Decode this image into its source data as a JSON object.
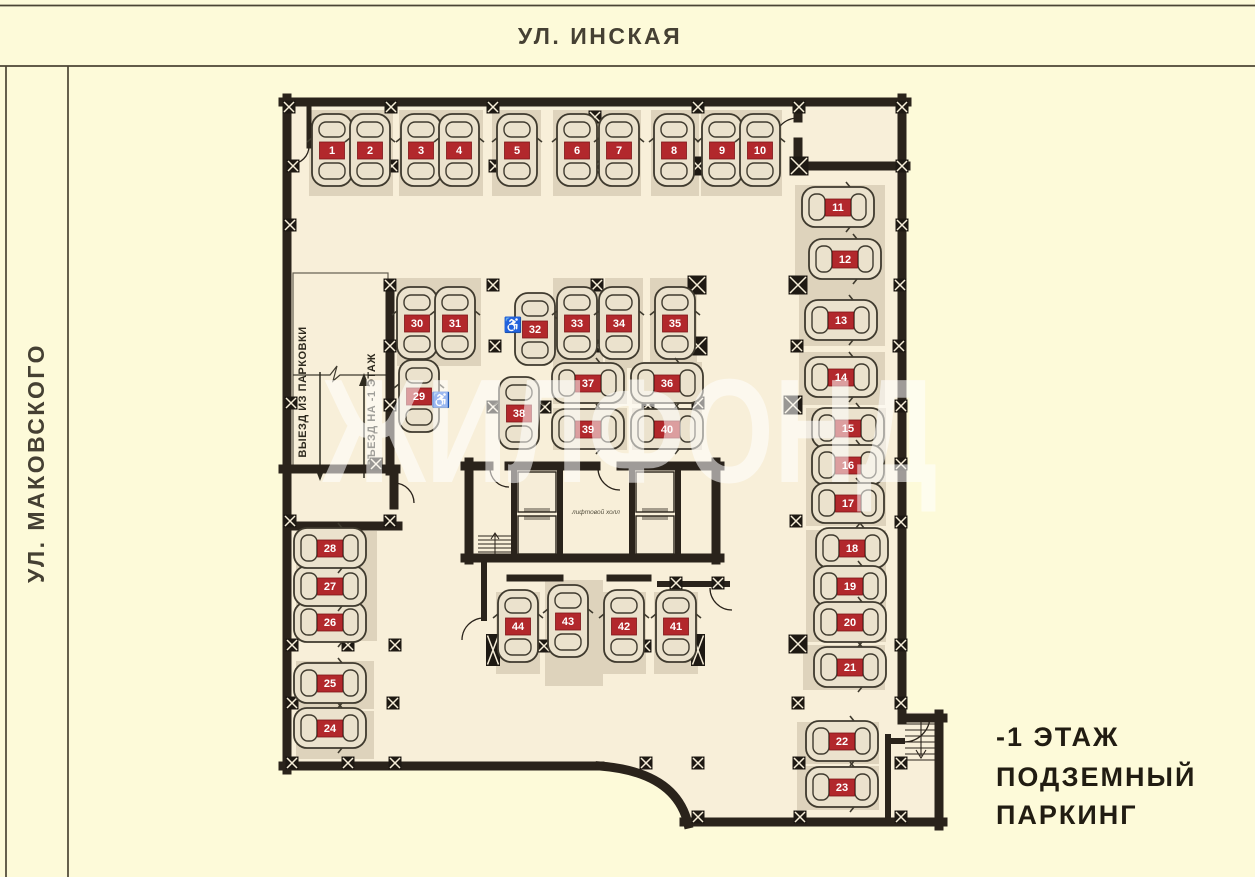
{
  "streets": {
    "top": "УЛ. ИНСКАЯ",
    "left": "УЛ. МАКОВСКОГО"
  },
  "floor_label": {
    "line1": "-1 ЭТАЖ",
    "line2": "ПОДЗЕМНЫЙ",
    "line3": "ПАРКИНГ"
  },
  "watermark": "ЖИЛФОНД",
  "ramp": {
    "exit_label": "ВЫЕЗД ИЗ ПАРКОВКИ",
    "entry_label": "ВЪЕЗД НА -1 ЭТАЖ"
  },
  "elevator_hall_label": "лифтовой холл",
  "colors": {
    "street_bg": "#fdfad9",
    "floor": "#f8efd9",
    "stall": "#ded3bc",
    "wall": "#2a231b",
    "badge": "#b2282c",
    "badge_text": "#ffffff",
    "frame_line": "#4b4434",
    "street_text": "#454033",
    "title_text": "#211c12",
    "car_body": "#ebe2cd",
    "car_outline": "#3f3a2e",
    "watermark_fill": "rgba(255,255,255,0.55)"
  },
  "plan": {
    "spots": [
      [
        1,
        332,
        150,
        "v"
      ],
      [
        2,
        370,
        150,
        "v"
      ],
      [
        3,
        421,
        150,
        "v"
      ],
      [
        4,
        459,
        150,
        "v"
      ],
      [
        5,
        517,
        150,
        "v"
      ],
      [
        6,
        577,
        150,
        "v"
      ],
      [
        7,
        619,
        150,
        "v"
      ],
      [
        8,
        674,
        150,
        "v"
      ],
      [
        9,
        722,
        150,
        "v"
      ],
      [
        10,
        760,
        150,
        "v"
      ],
      [
        11,
        838,
        207,
        "h"
      ],
      [
        12,
        845,
        259,
        "h"
      ],
      [
        13,
        841,
        320,
        "h"
      ],
      [
        14,
        841,
        377,
        "h"
      ],
      [
        15,
        848,
        428,
        "h"
      ],
      [
        16,
        848,
        465,
        "h"
      ],
      [
        17,
        848,
        503,
        "h"
      ],
      [
        18,
        852,
        548,
        "h"
      ],
      [
        19,
        850,
        586,
        "h"
      ],
      [
        20,
        850,
        622,
        "h"
      ],
      [
        21,
        850,
        667,
        "h"
      ],
      [
        22,
        842,
        741,
        "h"
      ],
      [
        23,
        842,
        787,
        "h"
      ],
      [
        24,
        330,
        728,
        "h"
      ],
      [
        25,
        330,
        683,
        "h"
      ],
      [
        26,
        330,
        622,
        "h"
      ],
      [
        27,
        330,
        586,
        "h"
      ],
      [
        28,
        330,
        548,
        "h"
      ],
      [
        29,
        419,
        396,
        "v"
      ],
      [
        30,
        417,
        323,
        "v"
      ],
      [
        31,
        455,
        323,
        "v"
      ],
      [
        32,
        535,
        329,
        "v"
      ],
      [
        33,
        577,
        323,
        "v"
      ],
      [
        34,
        619,
        323,
        "v"
      ],
      [
        35,
        675,
        323,
        "v"
      ],
      [
        36,
        667,
        383,
        "h"
      ],
      [
        37,
        588,
        383,
        "h"
      ],
      [
        38,
        519,
        413,
        "v"
      ],
      [
        39,
        588,
        429,
        "h"
      ],
      [
        40,
        667,
        429,
        "h"
      ],
      [
        41,
        676,
        626,
        "v"
      ],
      [
        42,
        624,
        626,
        "v"
      ],
      [
        43,
        568,
        621,
        "v"
      ],
      [
        44,
        518,
        626,
        "v"
      ]
    ],
    "stalls": [
      [
        309,
        110,
        84,
        86
      ],
      [
        399,
        110,
        84,
        86
      ],
      [
        492,
        110,
        49,
        86
      ],
      [
        553,
        110,
        48,
        86
      ],
      [
        598,
        110,
        43,
        86
      ],
      [
        651,
        110,
        48,
        86
      ],
      [
        701,
        110,
        81,
        86
      ],
      [
        795,
        185,
        90,
        110
      ],
      [
        799,
        293,
        86,
        53
      ],
      [
        799,
        352,
        86,
        53
      ],
      [
        806,
        408,
        80,
        118
      ],
      [
        806,
        530,
        80,
        112
      ],
      [
        803,
        645,
        82,
        45
      ],
      [
        797,
        722,
        82,
        42
      ],
      [
        797,
        766,
        82,
        44
      ],
      [
        296,
        531,
        81,
        110
      ],
      [
        296,
        661,
        78,
        48
      ],
      [
        296,
        711,
        78,
        48
      ],
      [
        397,
        278,
        84,
        88
      ],
      [
        553,
        278,
        50,
        90
      ],
      [
        605,
        278,
        38,
        90
      ],
      [
        650,
        278,
        47,
        90
      ],
      [
        553,
        362,
        74,
        42
      ],
      [
        553,
        408,
        74,
        42
      ],
      [
        632,
        362,
        70,
        42
      ],
      [
        632,
        408,
        70,
        42
      ],
      [
        496,
        592,
        44,
        82
      ],
      [
        545,
        580,
        58,
        106
      ],
      [
        602,
        592,
        44,
        82
      ],
      [
        654,
        592,
        44,
        82
      ]
    ],
    "columns": [
      [
        289,
        107,
        1
      ],
      [
        391,
        107,
        1
      ],
      [
        493,
        107,
        1
      ],
      [
        698,
        107,
        1
      ],
      [
        799,
        107,
        1
      ],
      [
        902,
        107,
        1
      ],
      [
        595,
        117,
        1
      ],
      [
        595,
        167,
        1
      ],
      [
        293,
        166,
        1
      ],
      [
        392,
        166,
        1
      ],
      [
        495,
        166,
        1
      ],
      [
        698,
        166,
        2
      ],
      [
        799,
        166,
        2
      ],
      [
        902,
        166,
        1
      ],
      [
        290,
        225,
        1
      ],
      [
        902,
        225,
        1
      ],
      [
        390,
        285,
        1
      ],
      [
        493,
        285,
        1
      ],
      [
        597,
        285,
        1
      ],
      [
        697,
        285,
        2
      ],
      [
        798,
        285,
        2
      ],
      [
        900,
        285,
        1
      ],
      [
        390,
        346,
        1
      ],
      [
        495,
        346,
        1
      ],
      [
        597,
        346,
        1
      ],
      [
        698,
        346,
        2
      ],
      [
        797,
        346,
        1
      ],
      [
        899,
        346,
        1
      ],
      [
        291,
        403,
        1
      ],
      [
        390,
        405,
        1
      ],
      [
        493,
        407,
        1
      ],
      [
        545,
        407,
        1
      ],
      [
        648,
        405,
        1
      ],
      [
        698,
        403,
        1
      ],
      [
        793,
        405,
        2
      ],
      [
        901,
        406,
        1
      ],
      [
        376,
        464,
        1
      ],
      [
        901,
        464,
        1
      ],
      [
        290,
        521,
        1
      ],
      [
        390,
        521,
        1
      ],
      [
        796,
        521,
        1
      ],
      [
        901,
        522,
        1
      ],
      [
        676,
        583,
        1
      ],
      [
        718,
        583,
        1
      ],
      [
        292,
        645,
        1
      ],
      [
        348,
        645,
        1
      ],
      [
        395,
        645,
        1
      ],
      [
        493,
        650,
        3
      ],
      [
        544,
        646,
        1
      ],
      [
        645,
        646,
        1
      ],
      [
        698,
        650,
        3
      ],
      [
        798,
        644,
        2
      ],
      [
        901,
        645,
        1
      ],
      [
        292,
        703,
        1
      ],
      [
        393,
        703,
        1
      ],
      [
        798,
        703,
        1
      ],
      [
        901,
        703,
        1
      ],
      [
        292,
        763,
        1
      ],
      [
        348,
        763,
        1
      ],
      [
        395,
        763,
        1
      ],
      [
        646,
        763,
        1
      ],
      [
        698,
        763,
        1
      ],
      [
        799,
        763,
        1
      ],
      [
        901,
        763,
        1
      ],
      [
        698,
        817,
        1
      ],
      [
        800,
        817,
        1
      ],
      [
        901,
        817,
        1
      ]
    ],
    "accessible_positions": [
      [
        441,
        400
      ],
      [
        513,
        325
      ]
    ],
    "elevator_shafts": [
      [
        518,
        472,
        38,
        40
      ],
      [
        518,
        516,
        38,
        38
      ],
      [
        636,
        472,
        38,
        40
      ],
      [
        636,
        516,
        38,
        38
      ]
    ]
  }
}
